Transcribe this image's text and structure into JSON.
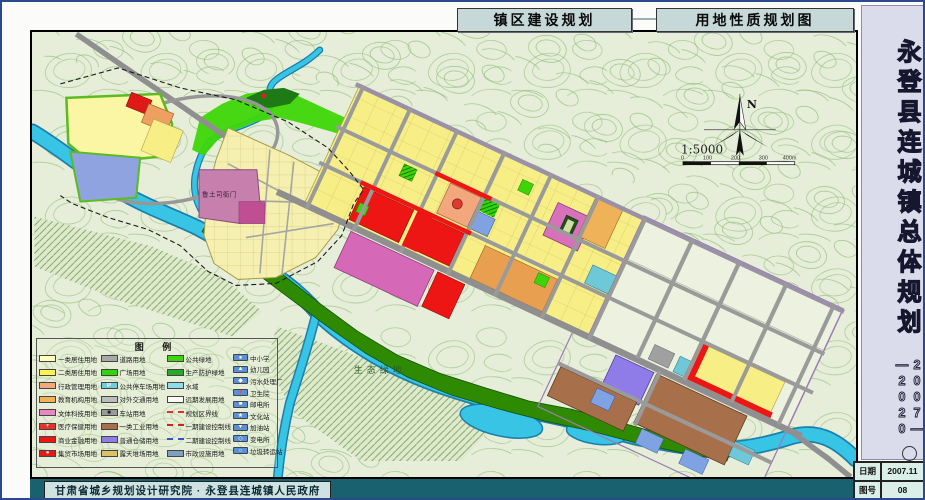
{
  "header": {
    "title_left": "镇区建设规划",
    "title_right": "用地性质规划图"
  },
  "sidebar": {
    "title": "永登县连城镇总体规划",
    "years": "2007—\n—2020"
  },
  "footer": {
    "credit": "甘肃省城乡规划设计研究院 · 永登县连城镇人民政府"
  },
  "info_table": {
    "date_label": "日期",
    "date_value": "2007.11",
    "sheet_label": "图号",
    "sheet_value": "08"
  },
  "map": {
    "compass_n": "N",
    "scale_text": "1:5000",
    "scale_ticks": [
      "0",
      "100",
      "200",
      "300",
      "400m"
    ],
    "labels": {
      "historic_site": "鲁土司衙门",
      "eco_green": "生态绿地"
    }
  },
  "legend": {
    "title": "图 例",
    "columns": [
      [
        {
          "swatch": {
            "type": "fill",
            "color": "#ffffbe"
          },
          "label": "一类居住用地"
        },
        {
          "swatch": {
            "type": "fill",
            "color": "#fdf24f"
          },
          "label": "二类居住用地"
        },
        {
          "swatch": {
            "type": "fill",
            "color": "#f2a87c"
          },
          "label": "行政管理用地"
        },
        {
          "swatch": {
            "type": "fill",
            "color": "#f0b258"
          },
          "label": "教育机构用地"
        },
        {
          "swatch": {
            "type": "fill",
            "color": "#ea86c2"
          },
          "label": "文体科技用地"
        },
        {
          "swatch": {
            "type": "fill",
            "color": "#e63229",
            "symbol": "+",
            "symbolColor": "#ffffff"
          },
          "label": "医疗保健用地"
        },
        {
          "swatch": {
            "type": "fill",
            "color": "#ee1515"
          },
          "label": "商业金融用地"
        },
        {
          "swatch": {
            "type": "fill",
            "color": "#ee1515",
            "symbol": "●",
            "symbolColor": "#ffffff"
          },
          "label": "集贸市场用地"
        }
      ],
      [
        {
          "swatch": {
            "type": "fill",
            "color": "#a8a8a8"
          },
          "label": "道路用地"
        },
        {
          "swatch": {
            "type": "fill",
            "color": "#2fd40a",
            "hatch": "dark"
          },
          "label": "广场用地"
        },
        {
          "swatch": {
            "type": "fill",
            "color": "#72ccd8",
            "symbol": "P",
            "symbolColor": "#ffffff"
          },
          "label": "公共停车场用地"
        },
        {
          "swatch": {
            "type": "fill",
            "color": "#bcbcbc"
          },
          "label": "对外交通用地"
        },
        {
          "swatch": {
            "type": "fill",
            "color": "#9a9a9a",
            "symbol": "■",
            "symbolColor": "#222222"
          },
          "label": "车站用地"
        },
        {
          "swatch": {
            "type": "fill",
            "color": "#a8704a"
          },
          "label": "一类工业用地"
        },
        {
          "swatch": {
            "type": "fill",
            "color": "#8f7ce8"
          },
          "label": "普通仓储用地"
        },
        {
          "swatch": {
            "type": "fill",
            "color": "#dcc06a"
          },
          "label": "露天堆场用地"
        }
      ],
      [
        {
          "swatch": {
            "type": "fill",
            "color": "#3fd40a"
          },
          "label": "公共绿地"
        },
        {
          "swatch": {
            "type": "fill",
            "color": "#28a828"
          },
          "label": "生产防护绿地"
        },
        {
          "swatch": {
            "type": "fill",
            "color": "#8fdde8"
          },
          "label": "水域"
        },
        {
          "swatch": {
            "type": "fill",
            "color": "#fbfbf4"
          },
          "label": "远期发展用地"
        },
        {
          "swatch": {
            "type": "line",
            "color": "#e03030",
            "style": "dash"
          },
          "label": "规划区界线"
        },
        {
          "swatch": {
            "type": "line",
            "color": "#d02020",
            "style": "dashdot"
          },
          "label": "一期建设控制线"
        },
        {
          "swatch": {
            "type": "line",
            "color": "#3355cc",
            "style": "dashdot"
          },
          "label": "二期建设控制线"
        },
        {
          "swatch": {
            "type": "fill",
            "color": "#7f9fc0",
            "hatch": "blue"
          },
          "label": "市政设施用地"
        }
      ],
      [
        {
          "swatch": {
            "type": "facility",
            "color": "#5b8fd6",
            "symbol": "●",
            "symbolColor": "#ffffff"
          },
          "label": "中小学"
        },
        {
          "swatch": {
            "type": "facility",
            "color": "#5b8fd6",
            "symbol": "▲",
            "symbolColor": "#ffffff"
          },
          "label": "幼儿园"
        },
        {
          "swatch": {
            "type": "facility",
            "color": "#5b8fd6",
            "symbol": "◆",
            "symbolColor": "#ffffff"
          },
          "label": "污水处理厂"
        },
        {
          "swatch": {
            "type": "facility",
            "color": "#5b8fd6",
            "symbol": "+",
            "symbolColor": "#ff4040"
          },
          "label": "卫生院"
        },
        {
          "swatch": {
            "type": "facility",
            "color": "#5b8fd6",
            "symbol": "■",
            "symbolColor": "#ffffff"
          },
          "label": "邮电所"
        },
        {
          "swatch": {
            "type": "facility",
            "color": "#5b8fd6",
            "symbol": "★",
            "symbolColor": "#ffffff"
          },
          "label": "文化站"
        },
        {
          "swatch": {
            "type": "facility",
            "color": "#5b8fd6",
            "symbol": "▼",
            "symbolColor": "#ffffff"
          },
          "label": "加油站"
        },
        {
          "swatch": {
            "type": "facility",
            "color": "#5b8fd6",
            "symbol": "◇",
            "symbolColor": "#ffffff"
          },
          "label": "变电所"
        },
        {
          "swatch": {
            "type": "facility",
            "color": "#5b8fd6",
            "symbol": "○",
            "symbolColor": "#ffffff"
          },
          "label": "垃圾转运站"
        }
      ]
    ]
  }
}
